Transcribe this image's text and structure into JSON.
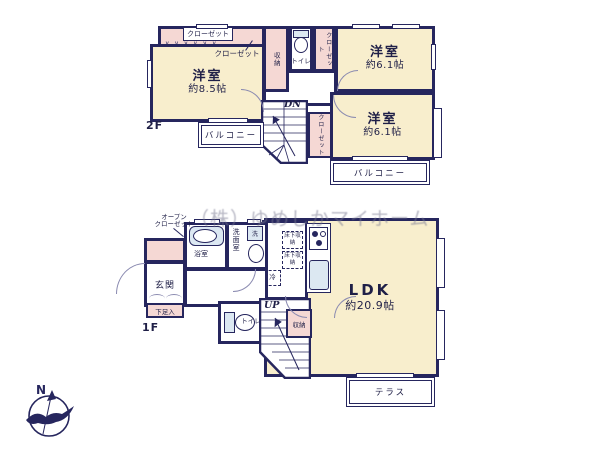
{
  "floorplan": {
    "watermark": "（株）ゆめしかマイホーム",
    "compass": {
      "north": "N"
    },
    "colors": {
      "wall": "#26265e",
      "room_fill": "#f8eecd",
      "closet_fill": "#f5d8d4",
      "fixture_fill": "#dce8f2"
    },
    "icons": {
      "compass": "compass-north-arrow",
      "bathtub": "bathtub",
      "toilet": "toilet-bowl",
      "stove": "stove-burners",
      "sink": "wash-basin"
    },
    "f2": {
      "label": "2F",
      "room85": {
        "name": "洋室",
        "size": "約8.5帖"
      },
      "room61a": {
        "name": "洋室",
        "size": "約6.1帖"
      },
      "room61b": {
        "name": "洋室",
        "size": "約6.1帖"
      },
      "closet_box": "クローゼット",
      "closet_leader": "クローゼット",
      "storage": "収納",
      "toilet": "トイレ",
      "closet_a": "クローゼット",
      "closet_b": "クローゼット",
      "stairs_dir": "DN",
      "balcony_left": "バルコニー",
      "balcony_right": "バルコニー",
      "folding_marks": "∨∨∨∨∨∨"
    },
    "f1": {
      "label": "1F",
      "open_closet_line1": "オープン",
      "open_closet_line2": "クローゼット",
      "entrance": "玄関",
      "shoe_box": "下足入",
      "bath": "浴室",
      "washroom": "洗面室",
      "laundry": "洗",
      "underfloor_storage": "床下収納",
      "fridge": "冷",
      "ldk": {
        "name": "LDK",
        "size": "約20.9帖"
      },
      "toilet": "トイレ",
      "stairs_dir": "UP",
      "storage": "収納",
      "terrace": "テラス"
    }
  }
}
